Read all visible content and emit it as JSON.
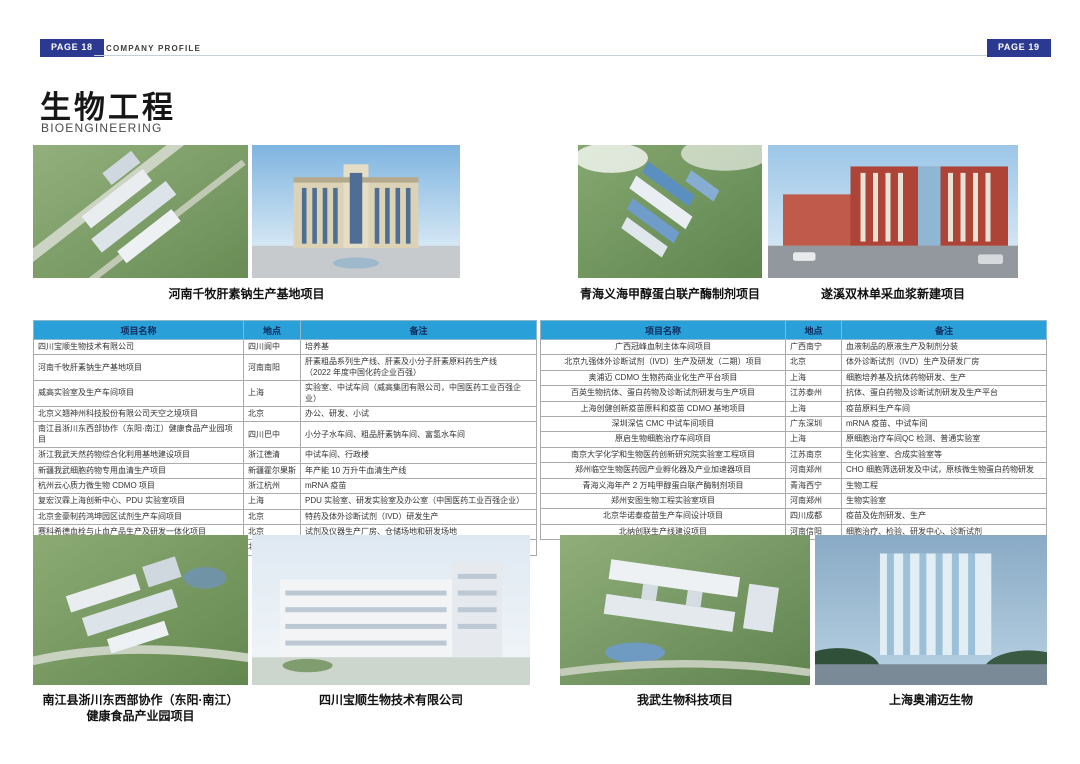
{
  "page": {
    "left_badge": "PAGE 18",
    "right_badge": "PAGE 19",
    "header_label": "COMPANY PROFILE",
    "title": "生物工程",
    "subtitle": "BIOENGINEERING"
  },
  "colors": {
    "badge_navy": "#2b3990",
    "table_header_blue": "#2aa0d8",
    "table_header_text": "#0e2a5c",
    "header_rule": "#c6cfdd"
  },
  "top_gallery": {
    "captions": [
      "河南千牧肝素钠生产基地项目",
      "青海义海甲醇蛋白联产酶制剂项目",
      "遂溪双林单采血浆新建项目"
    ]
  },
  "bottom_gallery": {
    "captions": [
      "南江县浙川东西部协作（东阳·南江）\n健康食品产业园项目",
      "四川宝顺生物技术有限公司",
      "我武生物科技项目",
      "上海奥浦迈生物"
    ]
  },
  "table": {
    "columns": {
      "name": "项目名称",
      "location": "地点",
      "note": "备注"
    },
    "left_rows": [
      {
        "name": "四川宝顺生物技术有限公司",
        "location": "四川阆中",
        "note": "培养基"
      },
      {
        "name": "河南千牧肝素钠生产基地项目",
        "location": "河南南阳",
        "note": "肝素粗品系列生产线、肝素及小分子肝素原料药生产线\n（2022 年度中国化药企业百强）"
      },
      {
        "name": "威高实验室及生产车间项目",
        "location": "上海",
        "note": "实验室、中试车间（威高集团有限公司，中国医药工业百强企业）"
      },
      {
        "name": "北京义翘神州科技股份有限公司天空之境项目",
        "location": "北京",
        "note": "办公、研发、小试"
      },
      {
        "name": "南江县浙川东西部协作（东阳·南江）健康食品产业园项目",
        "location": "四川巴中",
        "note": "小分子水车间、粗品肝素钠车间、富氢水车间"
      },
      {
        "name": "浙江我武天然药物综合化利用基地建设项目",
        "location": "浙江德清",
        "note": "中试车间、行政楼"
      },
      {
        "name": "新疆我武细胞药物专用血清生产项目",
        "location": "新疆霍尔果斯",
        "note": "年产能 10 万升牛血清生产线"
      },
      {
        "name": "杭州云心质力微生物 CDMO 项目",
        "location": "浙江杭州",
        "note": "mRNA 疫苗"
      },
      {
        "name": "复宏汉霖上海创新中心、PDU 实验室项目",
        "location": "上海",
        "note": "PDU 实验室、研发实验室及办公室（中国医药工业百强企业）"
      },
      {
        "name": "北京金豪制药鸿坤园区试剂生产车间项目",
        "location": "北京",
        "note": "特药及体外诊断试剂（IVD）研发生产"
      },
      {
        "name": "赛科希德血栓与止血产品生产及研发一体化项目",
        "location": "北京",
        "note": "试剂及仪器生产厂房、仓储场地和研发场地"
      },
      {
        "name": "北京华氏信华科单克隆抗体原液中试厂房项目",
        "location": "北京",
        "note": "干细胞研究中心和细胞库"
      }
    ],
    "right_rows": [
      {
        "name": "广西冠峰血制主体车间项目",
        "location": "广西南宁",
        "note": "血液制品的原液生产及制剂分装"
      },
      {
        "name": "北京九强体外诊断试剂（IVD）生产及研发（二期）项目",
        "location": "北京",
        "note": "体外诊断试剂（IVD）生产及研发厂房"
      },
      {
        "name": "奥浦迈 CDMO 生物药商业化生产平台项目",
        "location": "上海",
        "note": "细胞培养基及抗体药物研发、生产"
      },
      {
        "name": "百英生物抗体、蛋白药物及诊断试剂研发与生产项目",
        "location": "江苏泰州",
        "note": "抗体、蛋白药物及诊断试剂研发及生产平台"
      },
      {
        "name": "上海创健创新疫苗原料和疫苗 CDMO 基地项目",
        "location": "上海",
        "note": "疫苗原料生产车间"
      },
      {
        "name": "深圳深信 CMC 中试车间项目",
        "location": "广东深圳",
        "note": "mRNA 疫苗、中试车间"
      },
      {
        "name": "原启生物细胞治疗车间项目",
        "location": "上海",
        "note": "原细胞治疗车间QC 检测、普通实验室"
      },
      {
        "name": "南京大学化学和生物医药创新研究院实验室工程项目",
        "location": "江苏南京",
        "note": "生化实验室、合成实验室等"
      },
      {
        "name": "郑州临空生物医药园产业孵化器及产业加速器项目",
        "location": "河南郑州",
        "note": "CHO 细胞筛选研发及中试，原核微生物蛋白药物研发"
      },
      {
        "name": "青海义海年产 2 万吨甲醇蛋白联产酶制剂项目",
        "location": "青海西宁",
        "note": "生物工程"
      },
      {
        "name": "郑州安图生物工程实验室项目",
        "location": "河南郑州",
        "note": "生物实验室"
      },
      {
        "name": "北京华诺泰疫苗生产车间设计项目",
        "location": "四川成都",
        "note": "疫苗及佐剂研发、生产"
      },
      {
        "name": "北纳创联生产线建设项目",
        "location": "河南信阳",
        "note": "细胞治疗、检验、研发中心、诊断试剂"
      }
    ]
  }
}
